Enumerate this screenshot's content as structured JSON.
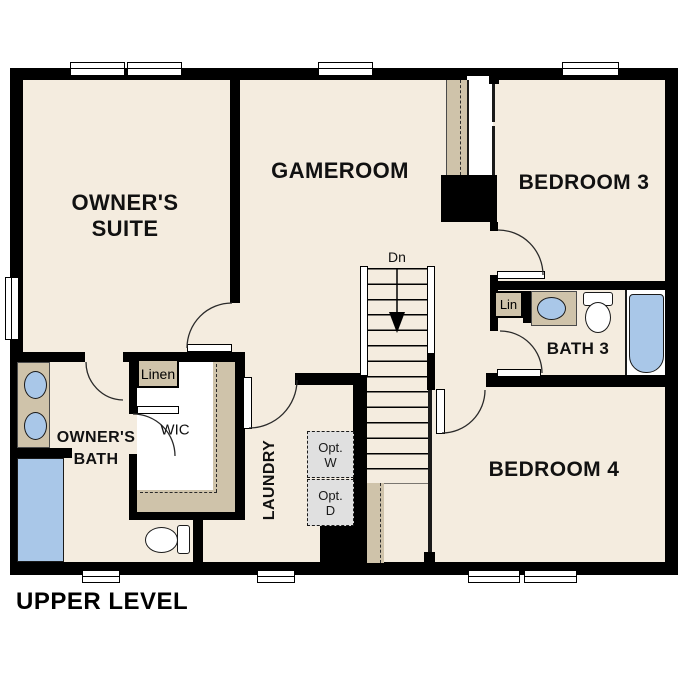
{
  "title": "UPPER LEVEL",
  "stairs": {
    "direction_label": "Dn"
  },
  "rooms": {
    "owners_suite": {
      "line1": "OWNER'S",
      "line2": "SUITE"
    },
    "gameroom": {
      "label": "GAMEROOM"
    },
    "bedroom3": {
      "label": "BEDROOM 3"
    },
    "bedroom4": {
      "label": "BEDROOM 4"
    },
    "owners_bath": {
      "line1": "OWNER'S",
      "line2": "BATH"
    },
    "wic": {
      "label": "WIC"
    },
    "laundry": {
      "label": "LAUNDRY"
    },
    "bath3": {
      "label": "BATH 3"
    },
    "lin_closet": {
      "label": "Lin"
    },
    "linen_closet": {
      "label": "Linen"
    },
    "optional_washer": {
      "line1": "Opt.",
      "line2": "W"
    },
    "optional_dryer": {
      "line1": "Opt.",
      "line2": "D"
    }
  },
  "colors": {
    "wall": "#000000",
    "floor": "#f4ecdf",
    "casework_tan": "#cfc3aa",
    "fixture_blue": "#a9c7e8",
    "optional_appliance_gray": "#e0e0e0",
    "background": "#ffffff"
  }
}
